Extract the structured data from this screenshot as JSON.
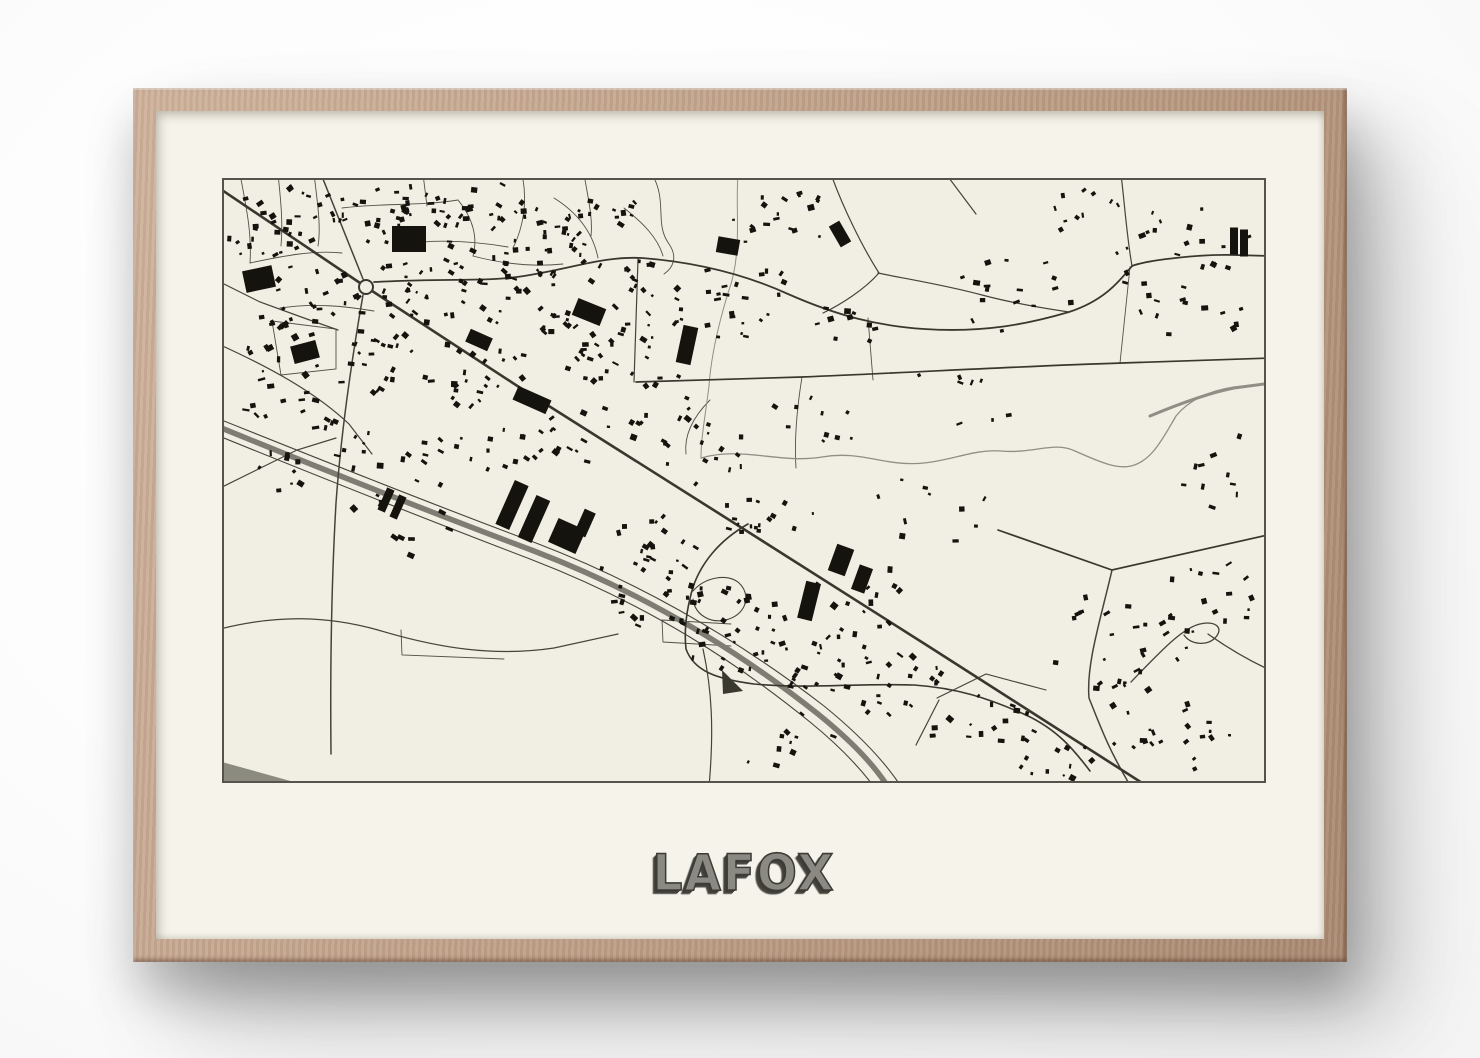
{
  "poster": {
    "title": "LAFOX"
  },
  "colors": {
    "wall": "#fdfdfd",
    "frame_wood_light": "#cfb29b",
    "frame_wood_dark": "#a98971",
    "mat": "#f5f3ea",
    "paper": "#f1eee3",
    "ink": "#15130e",
    "road_major": "#39382f",
    "road_minor": "#45443a",
    "street": "#525147",
    "water": "#8f8f86",
    "highway": "#7d7d73",
    "border": "#55534b",
    "area_gray": "#8b8b80",
    "title_face": "#8a8a82",
    "title_shadow": "#3c3b35"
  },
  "map": {
    "width": 1044,
    "height": 605,
    "roundabout": {
      "cx": 144,
      "cy": 109,
      "r": 7
    },
    "roads_major": [
      {
        "d": "M -6,8 L 144,109 L 300,211 L 520,350 L 706,468 L 928,610",
        "w": 2.6
      },
      {
        "d": "M 152,104 C 230,100 265,104 302,98 C 352,90 382,78 420,80 C 472,84 522,96 566,116 C 616,138 656,148 702,151 C 762,155 806,146 847,134 C 884,122 899,101 910,88 C 925,82 980,76 1012,77 L 1050,78",
        "w": 1.8
      },
      {
        "d": "M 414,204 L 580,199 C 700,194 802,188 900,185 C 962,183 1012,181 1050,180",
        "w": 1.7
      },
      {
        "d": "M 776,352 L 890,392 L 1050,356",
        "w": 1.7
      },
      {
        "d": "M 526,346 C 496,363 479,386 471,409 C 464,433 462,453 464,471 C 472,493 494,501 532,506 C 582,511 642,505 692,507 C 735,510 766,520 804,537 C 836,552 852,572 868,593",
        "w": 1.6
      }
    ],
    "roads_minor": [
      {
        "d": "M 141,117 C 130,180 119,255 114,325 C 110,395 108,480 109,576",
        "w": 1.5
      },
      {
        "d": "M 141,101 L 99,-4",
        "w": 1.5
      },
      {
        "d": "M 416,81 L 412,204",
        "w": 1.2
      },
      {
        "d": "M 609,-4 C 621,30 641,70 657,95 C 642,112 618,127 601,135",
        "w": 1.2
      },
      {
        "d": "M 899,-4 C 903,30 905,60 910,88",
        "w": 1.2
      },
      {
        "d": "M 717,522 L 694,567",
        "w": 1.2
      },
      {
        "d": "M 890,392 C 879,440 864,486 867,520 C 879,550 886,570 909,609",
        "w": 1.5
      },
      {
        "d": "M 909,504 C 937,475 960,450 978,446 C 995,442 1002,451 993,460 C 985,468 969,467 962,457",
        "w": 1.3
      },
      {
        "d": "M 986,456 C 1010,473 1030,484 1050,493",
        "w": 1.3
      },
      {
        "d": "M -6,102 L 38,124 L 82,140 L 116,152",
        "w": 1.2
      },
      {
        "d": "M -6,165 C 45,188 92,213 127,246 L 150,276",
        "w": 1.2
      },
      {
        "d": "M -6,312 L 75,272 L 114,260",
        "w": 1.2
      },
      {
        "d": "M -6,452 C 55,436 106,438 156,452 C 216,470 272,479 332,470 L 396,456",
        "w": 1.2
      },
      {
        "d": "M 481,471 C 490,512 492,552 487,609",
        "w": 1.2
      },
      {
        "d": "M 724,-4 L 754,36",
        "w": 1.2
      },
      {
        "d": "M 471,413 C 483,399 506,395 517,405 C 529,416 525,435 507,441 C 489,447 473,437 471,421",
        "w": 1.1
      },
      {
        "d": "M 715,520 L 764,496 L 824,512",
        "w": 1.1
      },
      {
        "d": "M 656,95 C 690,102 723,107 760,117 C 790,125 820,130 847,134",
        "w": 1.2
      }
    ],
    "streets": [
      "M 18,-4 C 24,28 30,55 28,85",
      "M 28,85 C 60,78 92,72 120,75",
      "M 56,-4 C 59,24 61,45 59,68",
      "M 92,-4 C 96,28 99,50 96,68",
      "M 120,30 C 160,25 200,28 236,22",
      "M 236,22 C 251,40 256,60 251,78",
      "M 182,66 C 216,61 251,63 286,69",
      "M 205,28 L 201,-4",
      "M 300,-4 C 306,24 301,50 291,70",
      "M 332,20 C 356,35 371,55 376,80",
      "M 251,78 C 281,86 311,89 341,86",
      "M 362,-4 C 366,20 371,40 369,58",
      "M 402,30 C 421,45 436,60 441,78",
      "M 430,-4 C 446,24 432,45 447,66 C 456,79 451,90 442,96",
      "M 58,130 C 92,125 122,128 152,133",
      "M 440,442 L 509,446 M 441,464 L 509,468 M 440,442 L 441,464",
      "M 50,143 L 114,151 L 114,191 L 59,197 Z",
      "M 179,452 L 180,477 L 282,481",
      "M 580,199 C 575,230 572,260 574,290",
      "M 646,140 L 651,202",
      "M 908,89 L 898,185",
      "M 488,222 C 470,240 462,258 464,276"
    ],
    "rivers": [
      {
        "d": "M 516,-4 C 513,35 521,75 506,115 C 496,148 489,178 487,208 C 483,240 479,260 479,280",
        "w": 1.0
      },
      {
        "d": "M 479,280 C 520,268 558,286 600,279 C 640,272 662,289 702,285 C 732,282 752,271 779,273 C 812,276 832,263 853,273 C 882,286 896,291 909,288 C 930,283 941,260 954,238 C 966,223 986,213 1012,209 L 1050,205",
        "w": 1.3
      },
      {
        "d": "M 928,238 C 952,228 986,215 1012,210 L 1050,205",
        "w": 3.0
      }
    ],
    "highway": {
      "band": {
        "d": "M -8,247 C 90,287 200,331 312,373 C 432,419 524,479 596,536 C 628,562 652,586 668,612",
        "w": 5.5
      },
      "edges": [
        {
          "d": "M -8,239 C 92,279 202,323 314,365 C 434,411 528,471 602,528 C 634,554 658,578 676,604",
          "w": 1.1
        },
        {
          "d": "M -8,256 C 88,295 198,339 308,381 C 428,427 518,487 588,544 C 620,570 644,596 660,620",
          "w": 1.1
        }
      ]
    },
    "areas": [
      {
        "d": "M 0,584 L 90,609 L 0,609 Z",
        "fill": "#8b8b80"
      },
      {
        "d": "M 500,492 L 521,513 L 501,516 Z",
        "fill": "#3a3930"
      }
    ],
    "building_clusters": [
      {
        "cx": 55,
        "cy": 50,
        "rx": 50,
        "ry": 45,
        "n": 30,
        "s": 5,
        "rot": -10
      },
      {
        "cx": 160,
        "cy": 35,
        "rx": 70,
        "ry": 30,
        "n": 35,
        "s": 5,
        "rot": 0
      },
      {
        "cx": 280,
        "cy": 45,
        "rx": 70,
        "ry": 40,
        "n": 40,
        "s": 5,
        "rot": 15
      },
      {
        "cx": 390,
        "cy": 60,
        "rx": 50,
        "ry": 50,
        "n": 30,
        "s": 5,
        "rot": 20
      },
      {
        "cx": 90,
        "cy": 125,
        "rx": 55,
        "ry": 40,
        "n": 28,
        "s": 5,
        "rot": -20
      },
      {
        "cx": 200,
        "cy": 110,
        "rx": 50,
        "ry": 35,
        "n": 30,
        "s": 5,
        "rot": 10
      },
      {
        "cx": 300,
        "cy": 120,
        "rx": 55,
        "ry": 40,
        "n": 32,
        "s": 5,
        "rot": 20
      },
      {
        "cx": 55,
        "cy": 200,
        "rx": 45,
        "ry": 45,
        "n": 20,
        "s": 6,
        "rot": -15
      },
      {
        "cx": 150,
        "cy": 180,
        "rx": 45,
        "ry": 35,
        "n": 22,
        "s": 5,
        "rot": 20
      },
      {
        "cx": 250,
        "cy": 190,
        "rx": 55,
        "ry": 40,
        "n": 26,
        "s": 5,
        "rot": 25
      },
      {
        "cx": 350,
        "cy": 180,
        "rx": 45,
        "ry": 40,
        "n": 22,
        "s": 5,
        "rot": 25
      },
      {
        "cx": 430,
        "cy": 140,
        "rx": 40,
        "ry": 45,
        "n": 20,
        "s": 5,
        "rot": 20
      },
      {
        "cx": 120,
        "cy": 270,
        "rx": 50,
        "ry": 30,
        "n": 14,
        "s": 6,
        "rot": 20
      },
      {
        "cx": 230,
        "cy": 280,
        "rx": 60,
        "ry": 35,
        "n": 16,
        "s": 5,
        "rot": 25
      },
      {
        "cx": 330,
        "cy": 260,
        "rx": 50,
        "ry": 35,
        "n": 18,
        "s": 5,
        "rot": 25
      },
      {
        "cx": 430,
        "cy": 230,
        "rx": 50,
        "ry": 40,
        "n": 18,
        "s": 5,
        "rot": 25
      },
      {
        "cx": 520,
        "cy": 120,
        "rx": 45,
        "ry": 55,
        "n": 22,
        "s": 5,
        "rot": 15
      },
      {
        "cx": 560,
        "cy": 40,
        "rx": 50,
        "ry": 35,
        "n": 18,
        "s": 5,
        "rot": 10
      },
      {
        "cx": 480,
        "cy": 280,
        "rx": 60,
        "ry": 40,
        "n": 14,
        "s": 5,
        "rot": 25
      },
      {
        "cx": 545,
        "cy": 340,
        "rx": 50,
        "ry": 22,
        "n": 16,
        "s": 4,
        "rot": 25
      },
      {
        "cx": 430,
        "cy": 395,
        "rx": 55,
        "ry": 60,
        "n": 40,
        "s": 5,
        "rot": 15
      },
      {
        "cx": 510,
        "cy": 450,
        "rx": 55,
        "ry": 45,
        "n": 30,
        "s": 5,
        "rot": 10
      },
      {
        "cx": 590,
        "cy": 480,
        "rx": 60,
        "ry": 35,
        "n": 24,
        "s": 5,
        "rot": 15
      },
      {
        "cx": 670,
        "cy": 505,
        "rx": 55,
        "ry": 35,
        "n": 22,
        "s": 5,
        "rot": 20
      },
      {
        "cx": 760,
        "cy": 545,
        "rx": 55,
        "ry": 30,
        "n": 18,
        "s": 5,
        "rot": 25
      },
      {
        "cx": 640,
        "cy": 420,
        "rx": 50,
        "ry": 35,
        "n": 12,
        "s": 6,
        "rot": 20
      },
      {
        "cx": 710,
        "cy": 330,
        "rx": 60,
        "ry": 40,
        "n": 10,
        "s": 5,
        "rot": 0
      },
      {
        "cx": 630,
        "cy": 145,
        "rx": 45,
        "ry": 20,
        "n": 10,
        "s": 5,
        "rot": 10
      },
      {
        "cx": 790,
        "cy": 120,
        "rx": 60,
        "ry": 45,
        "n": 16,
        "s": 5,
        "rot": 0
      },
      {
        "cx": 950,
        "cy": 70,
        "rx": 80,
        "ry": 45,
        "n": 22,
        "s": 5,
        "rot": 0
      },
      {
        "cx": 965,
        "cy": 135,
        "rx": 60,
        "ry": 25,
        "n": 12,
        "s": 5,
        "rot": 0
      },
      {
        "cx": 860,
        "cy": 35,
        "rx": 50,
        "ry": 25,
        "n": 10,
        "s": 4,
        "rot": -30
      },
      {
        "cx": 900,
        "cy": 470,
        "rx": 70,
        "ry": 60,
        "n": 30,
        "s": 5,
        "rot": -10
      },
      {
        "cx": 950,
        "cy": 560,
        "rx": 60,
        "ry": 40,
        "n": 20,
        "s": 5,
        "rot": -20
      },
      {
        "cx": 840,
        "cy": 590,
        "rx": 50,
        "ry": 25,
        "n": 12,
        "s": 5,
        "rot": 25
      },
      {
        "cx": 1000,
        "cy": 300,
        "rx": 40,
        "ry": 50,
        "n": 10,
        "s": 5,
        "rot": 0
      },
      {
        "cx": 740,
        "cy": 220,
        "rx": 60,
        "ry": 35,
        "n": 8,
        "s": 5,
        "rot": 0
      },
      {
        "cx": 180,
        "cy": 350,
        "rx": 60,
        "ry": 40,
        "n": 10,
        "s": 6,
        "rot": 25
      },
      {
        "cx": 60,
        "cy": 300,
        "rx": 40,
        "ry": 30,
        "n": 8,
        "s": 5,
        "rot": 20
      },
      {
        "cx": 560,
        "cy": 560,
        "rx": 60,
        "ry": 30,
        "n": 10,
        "s": 5,
        "rot": 20
      },
      {
        "cx": 990,
        "cy": 420,
        "rx": 50,
        "ry": 50,
        "n": 14,
        "s": 5,
        "rot": -10
      },
      {
        "cx": 600,
        "cy": 240,
        "rx": 60,
        "ry": 40,
        "n": 10,
        "s": 4,
        "rot": 20
      }
    ],
    "large_buildings": [
      {
        "cx": 290,
        "cy": 327,
        "w": 15,
        "h": 48,
        "rot": 24
      },
      {
        "cx": 312,
        "cy": 341,
        "w": 15,
        "h": 46,
        "rot": 24
      },
      {
        "cx": 345,
        "cy": 358,
        "w": 30,
        "h": 26,
        "rot": 24
      },
      {
        "cx": 363,
        "cy": 345,
        "w": 12,
        "h": 26,
        "rot": 24
      },
      {
        "cx": 164,
        "cy": 322,
        "w": 8,
        "h": 24,
        "rot": 24
      },
      {
        "cx": 176,
        "cy": 329,
        "w": 8,
        "h": 24,
        "rot": 24
      },
      {
        "cx": 310,
        "cy": 222,
        "w": 36,
        "h": 15,
        "rot": 24
      },
      {
        "cx": 187,
        "cy": 61,
        "w": 34,
        "h": 26,
        "rot": 0
      },
      {
        "cx": 37,
        "cy": 101,
        "w": 30,
        "h": 22,
        "rot": -12
      },
      {
        "cx": 367,
        "cy": 134,
        "w": 30,
        "h": 18,
        "rot": 22
      },
      {
        "cx": 465,
        "cy": 167,
        "w": 15,
        "h": 38,
        "rot": 12
      },
      {
        "cx": 619,
        "cy": 382,
        "w": 18,
        "h": 28,
        "rot": 20
      },
      {
        "cx": 640,
        "cy": 401,
        "w": 14,
        "h": 26,
        "rot": 20
      },
      {
        "cx": 587,
        "cy": 423,
        "w": 15,
        "h": 38,
        "rot": 14
      },
      {
        "cx": 1012,
        "cy": 63,
        "w": 8,
        "h": 27,
        "rot": 0
      },
      {
        "cx": 1022,
        "cy": 65,
        "w": 8,
        "h": 27,
        "rot": 0
      },
      {
        "cx": 83,
        "cy": 174,
        "w": 26,
        "h": 18,
        "rot": -15
      },
      {
        "cx": 257,
        "cy": 162,
        "w": 24,
        "h": 14,
        "rot": 24
      },
      {
        "cx": 506,
        "cy": 68,
        "w": 22,
        "h": 16,
        "rot": 10
      },
      {
        "cx": 618,
        "cy": 56,
        "w": 12,
        "h": 24,
        "rot": -30
      }
    ]
  }
}
